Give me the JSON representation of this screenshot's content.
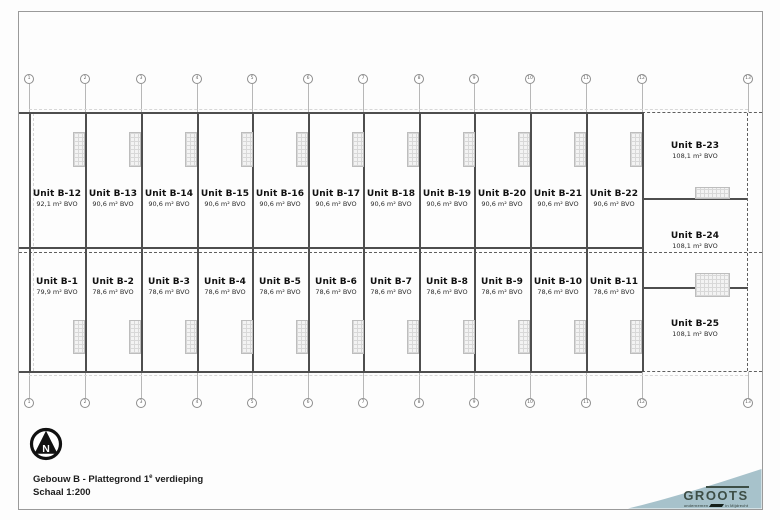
{
  "drawing": {
    "title_prefix": "Gebouw B - Plattegrond 1",
    "title_sup": "e",
    "title_suffix": " verdieping",
    "scale": "Schaal 1:200",
    "north_letter": "N"
  },
  "logo": {
    "brand_gr": "GR",
    "brand_oo": "OO",
    "brand_ts": "TS",
    "tagline_left": "ondernemen",
    "tagline_right": "in Mijdrecht",
    "accent_color": "#a7c2cb",
    "brand_color": "#3d4e46"
  },
  "grid": {
    "labels": [
      "1",
      "2",
      "3",
      "4",
      "5",
      "6",
      "7",
      "8",
      "9",
      "10",
      "11",
      "12",
      "13"
    ]
  },
  "units": {
    "top_row": [
      {
        "name": "Unit B-12",
        "area": "92,1 m² BVO"
      },
      {
        "name": "Unit B-13",
        "area": "90,6 m² BVO"
      },
      {
        "name": "Unit B-14",
        "area": "90,6 m² BVO"
      },
      {
        "name": "Unit B-15",
        "area": "90,6 m² BVO"
      },
      {
        "name": "Unit B-16",
        "area": "90,6 m² BVO"
      },
      {
        "name": "Unit B-17",
        "area": "90,6 m² BVO"
      },
      {
        "name": "Unit B-18",
        "area": "90,6 m² BVO"
      },
      {
        "name": "Unit B-19",
        "area": "90,6 m² BVO"
      },
      {
        "name": "Unit B-20",
        "area": "90,6 m² BVO"
      },
      {
        "name": "Unit B-21",
        "area": "90,6 m² BVO"
      },
      {
        "name": "Unit B-22",
        "area": "90,6 m² BVO"
      }
    ],
    "bottom_row": [
      {
        "name": "Unit B-1",
        "area": "79,9 m² BVO"
      },
      {
        "name": "Unit B-2",
        "area": "78,6 m² BVO"
      },
      {
        "name": "Unit B-3",
        "area": "78,6 m² BVO"
      },
      {
        "name": "Unit B-4",
        "area": "78,6 m² BVO"
      },
      {
        "name": "Unit B-5",
        "area": "78,6 m² BVO"
      },
      {
        "name": "Unit B-6",
        "area": "78,6 m² BVO"
      },
      {
        "name": "Unit B-7",
        "area": "78,6 m² BVO"
      },
      {
        "name": "Unit B-8",
        "area": "78,6 m² BVO"
      },
      {
        "name": "Unit B-9",
        "area": "78,6 m² BVO"
      },
      {
        "name": "Unit B-10",
        "area": "78,6 m² BVO"
      },
      {
        "name": "Unit B-11",
        "area": "78,6 m² BVO"
      }
    ],
    "right_column": [
      {
        "name": "Unit B-23",
        "area": "108,1 m² BVO"
      },
      {
        "name": "Unit B-24",
        "area": "108,1 m² BVO"
      },
      {
        "name": "Unit B-25",
        "area": "108,1 m² BVO"
      }
    ]
  }
}
